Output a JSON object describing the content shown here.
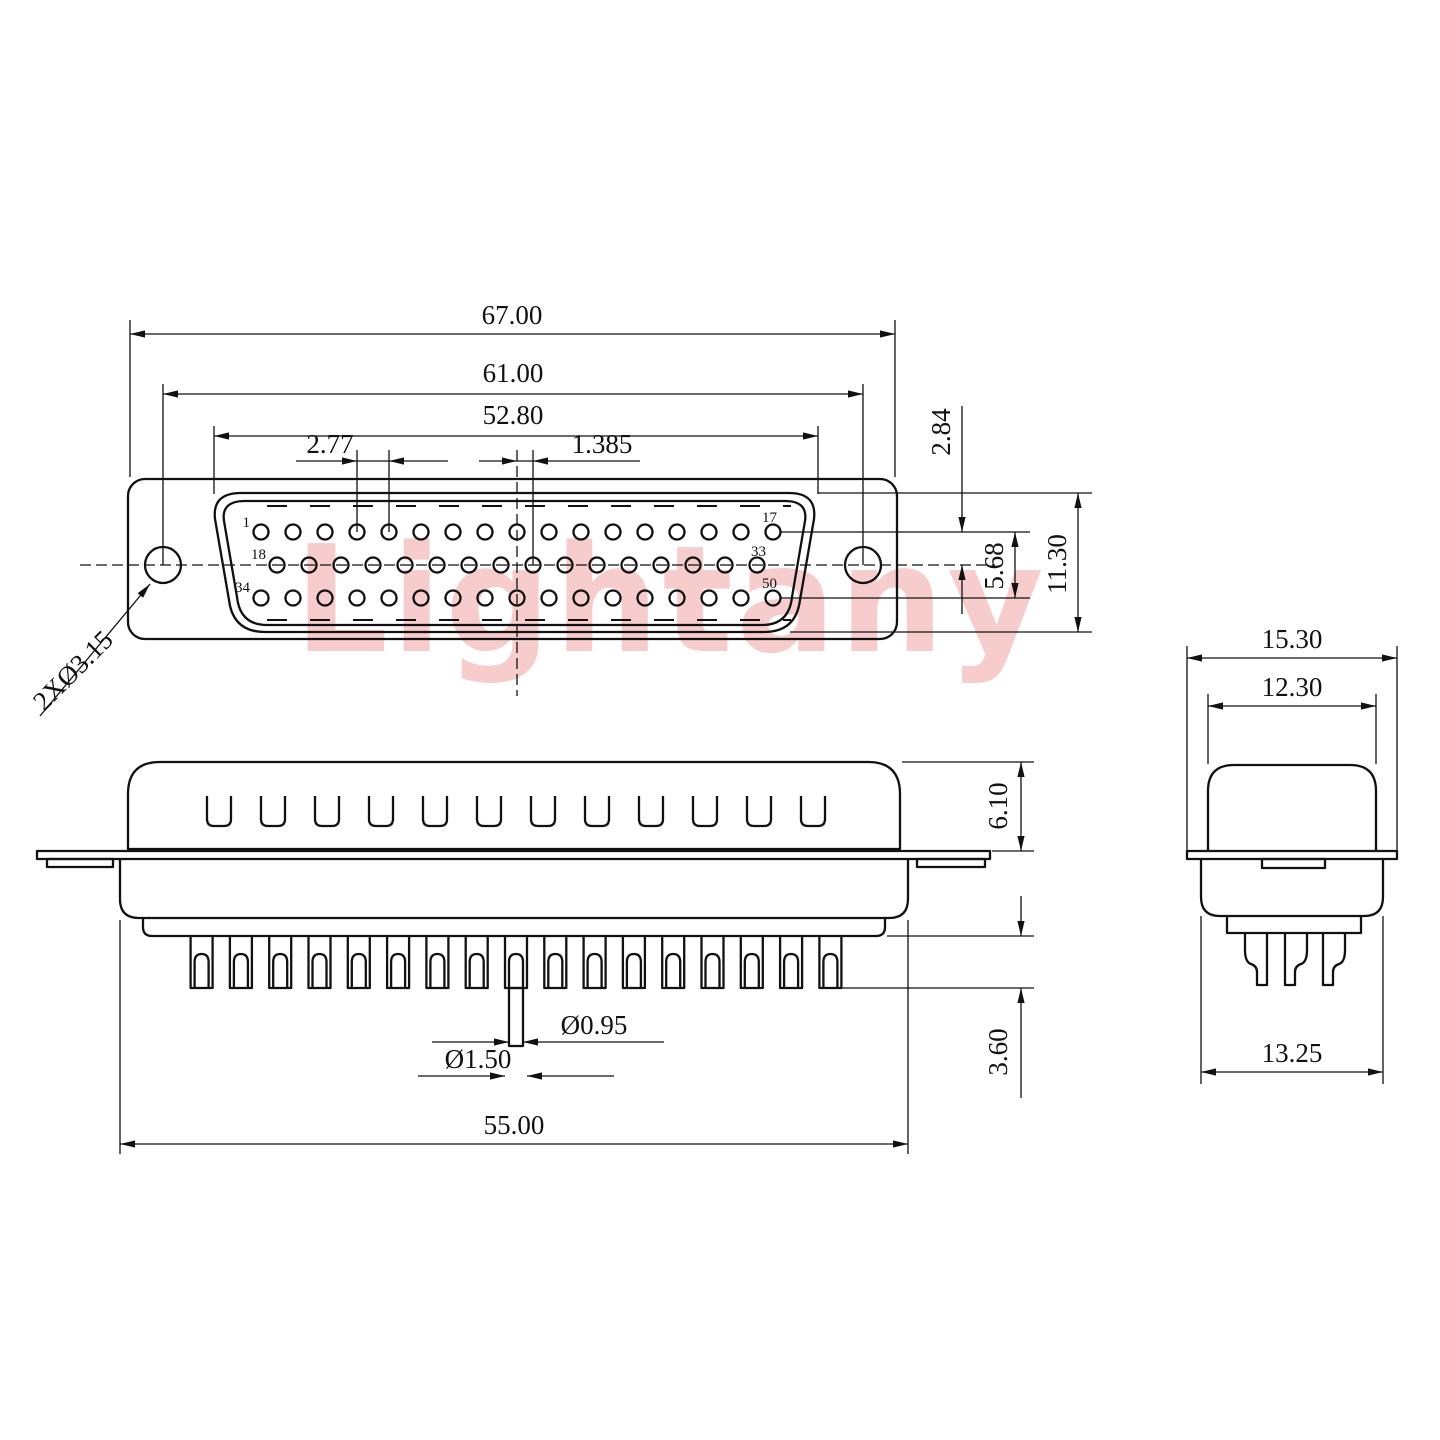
{
  "background": "#ffffff",
  "line_color": "#111111",
  "watermark": {
    "text": "Lightany",
    "color": "#f7cccc"
  },
  "front_view": {
    "name": "front-view",
    "dimensions": {
      "overall_width": "67.00",
      "mounting_hole_span": "61.00",
      "insert_width": "52.80",
      "pin_pitch": "2.77",
      "row_stagger": "1.385",
      "row_offset_from_center": "2.84",
      "row_to_row": "5.68",
      "insert_height": "11.30",
      "mounting_hole_callout": "2XØ3.15"
    },
    "pin_numbers": {
      "top_first": "1",
      "top_last": "17",
      "middle_first": "18",
      "middle_last": "33",
      "bottom_first": "34",
      "bottom_last": "50"
    },
    "pin_counts": {
      "top": 17,
      "middle": 16,
      "bottom": 17
    }
  },
  "side_view": {
    "name": "side-view",
    "dimensions": {
      "shell_height": "6.10",
      "pin_protrusion": "3.60",
      "body_width": "55.00",
      "pin_diameter": "Ø0.95",
      "solder_cup_diameter": "Ø1.50"
    },
    "slot_count": 12,
    "tooth_count": 17
  },
  "end_view": {
    "name": "end-view",
    "dimensions": {
      "flange_width": "15.30",
      "shell_width": "12.30",
      "body_width": "13.25"
    },
    "pin_count": 3
  }
}
